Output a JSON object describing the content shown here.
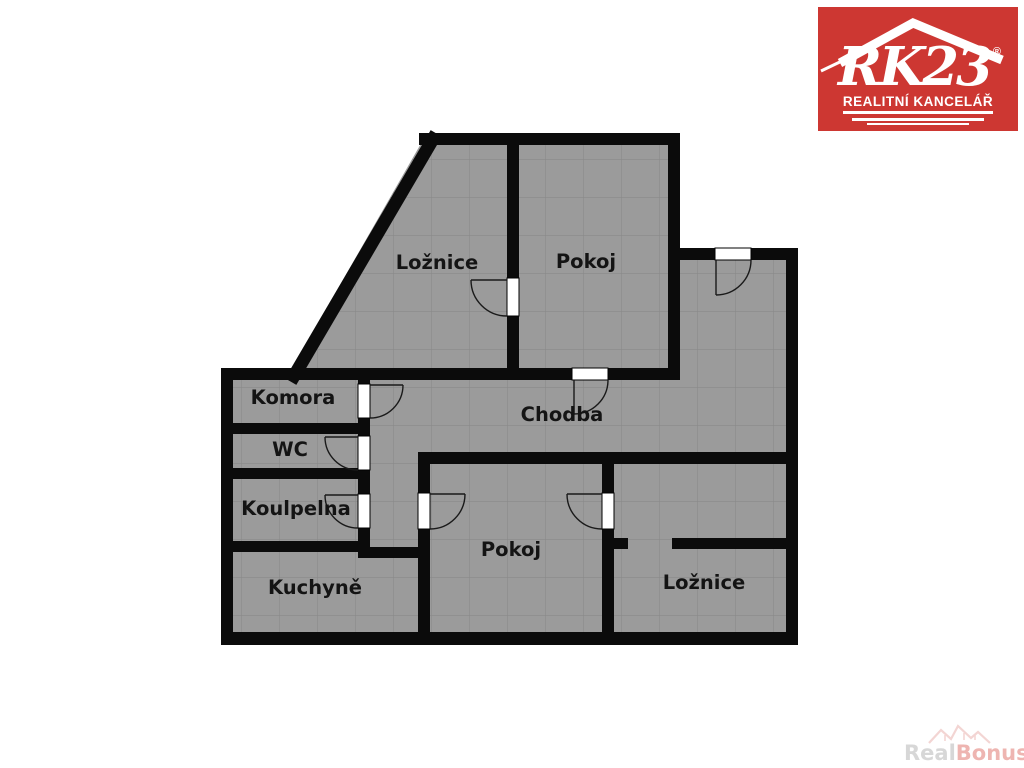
{
  "plan": {
    "colors": {
      "floor": "#9b9b9b",
      "grid": "#8a8a8a",
      "wall": "#0b0b0b",
      "door_gap": "#ffffff",
      "label": "#141414"
    },
    "rooms": [
      {
        "label": "Ložnice"
      },
      {
        "label": "Pokoj"
      },
      {
        "label": "Komora"
      },
      {
        "label": "Chodba"
      },
      {
        "label": "WC"
      },
      {
        "label": "Koulpelna"
      },
      {
        "label": "Kuchyně"
      },
      {
        "label": "Pokoj"
      },
      {
        "label": "Ložnice"
      }
    ]
  },
  "logo": {
    "brand": "RK23",
    "reg": "®",
    "tagline": "REALITNÍ KANCELÁŘ",
    "bg_color": "#cd3732",
    "fg_color": "#ffffff",
    "icon": "roof-icon"
  },
  "watermark": {
    "real": "Real",
    "bonus": "Bonus",
    "tld": ".cz",
    "icon": "houses-icon"
  }
}
